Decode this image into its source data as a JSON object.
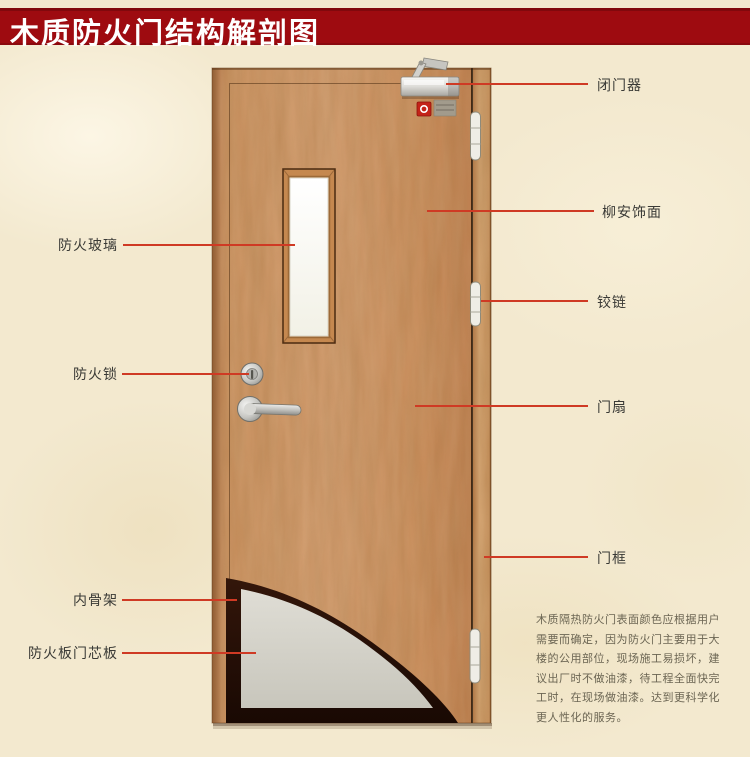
{
  "title": {
    "text": "木质防火门结构解剖图"
  },
  "labels": {
    "right": [
      {
        "id": "door-closer",
        "text": "闭门器"
      },
      {
        "id": "lauan-veneer",
        "text": "柳安饰面"
      },
      {
        "id": "hinge",
        "text": "铰链"
      },
      {
        "id": "door-leaf",
        "text": "门扇"
      },
      {
        "id": "door-frame",
        "text": "门框"
      }
    ],
    "left": [
      {
        "id": "fire-glass",
        "text": "防火玻璃"
      },
      {
        "id": "fire-lock",
        "text": "防火锁"
      },
      {
        "id": "inner-skeleton",
        "text": "内骨架"
      },
      {
        "id": "fire-board-core",
        "text": "防火板门芯板"
      }
    ]
  },
  "description": {
    "lines": [
      "木质隔热防火门表面颜色应根据用户",
      "需要而确定，因为防火门主要用于大",
      "楼的公用部位，现场施工易损坏，建",
      "议出厂时不做油漆，待工程全面快完",
      "工时，在现场做油漆。达到更科学化",
      "更人性化的服务。"
    ]
  },
  "colors": {
    "banner_red": "#9e0b10",
    "callout_red": "#cf3a24",
    "background_cream": "#f3e9cf",
    "door_wood": "#c9905e",
    "core_gray": "#d9d7cf",
    "skeleton_dark": "#200e04",
    "label_text": "#3a3a36",
    "description_text": "#6b6553"
  }
}
